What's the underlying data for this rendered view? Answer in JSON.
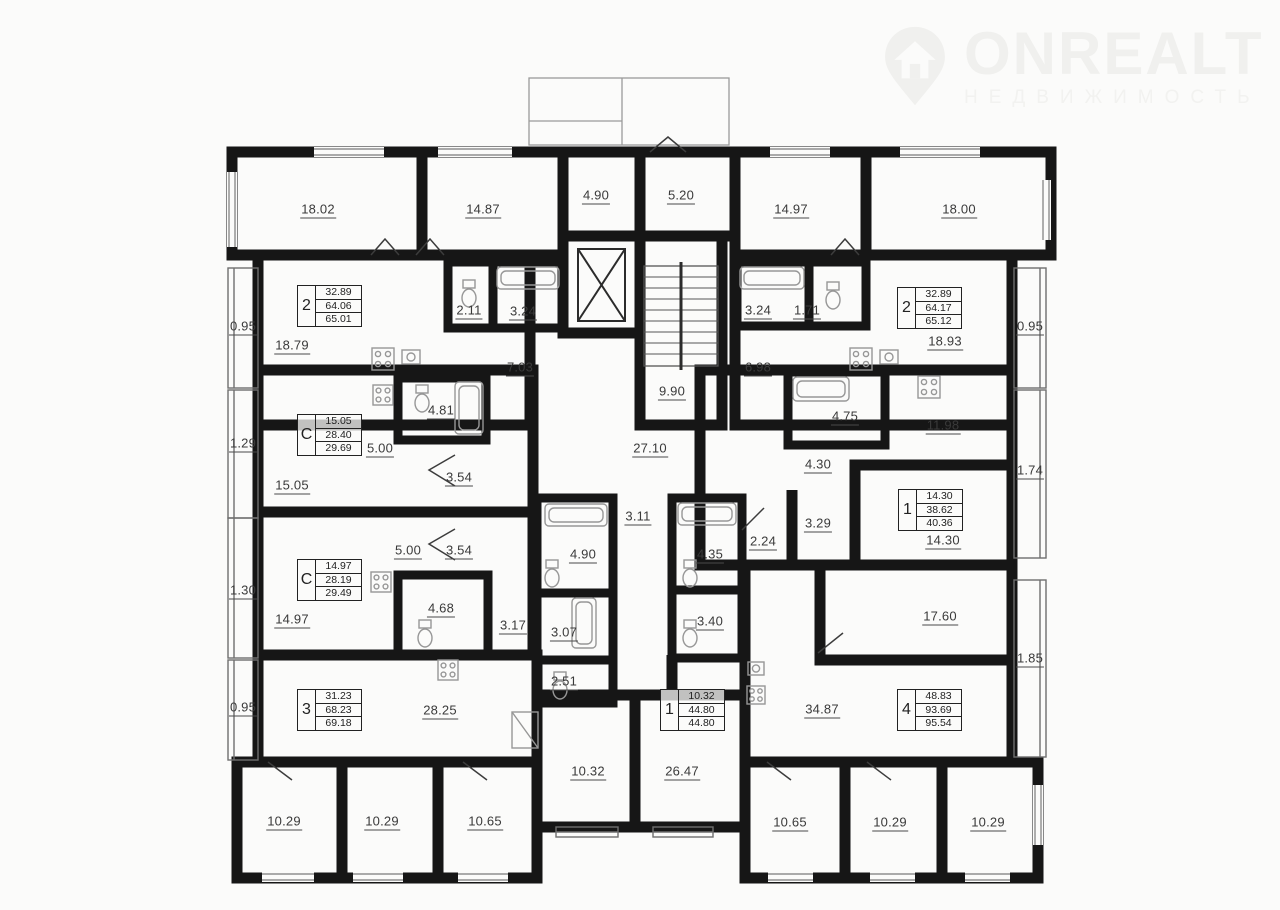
{
  "watermark": {
    "brand": "ONREALT",
    "tagline": "НЕДВИЖИМОСТЬ"
  },
  "colors": {
    "background": "#fbfbfa",
    "wall": "#161616",
    "label": "#3a3a3a",
    "watermark": "#f0f0ee"
  },
  "floorplan": {
    "room_labels": [
      {
        "value": "18.02",
        "x": 318,
        "y": 210
      },
      {
        "value": "14.87",
        "x": 483,
        "y": 210
      },
      {
        "value": "4.90",
        "x": 596,
        "y": 196
      },
      {
        "value": "5.20",
        "x": 681,
        "y": 196
      },
      {
        "value": "14.97",
        "x": 791,
        "y": 210
      },
      {
        "value": "18.00",
        "x": 959,
        "y": 210
      },
      {
        "value": "0.95",
        "x": 243,
        "y": 327
      },
      {
        "value": "1.29",
        "x": 243,
        "y": 444
      },
      {
        "value": "1.30",
        "x": 243,
        "y": 591
      },
      {
        "value": "0.95",
        "x": 243,
        "y": 708
      },
      {
        "value": "0.95",
        "x": 1030,
        "y": 327
      },
      {
        "value": "1.74",
        "x": 1030,
        "y": 471
      },
      {
        "value": "1.85",
        "x": 1030,
        "y": 659
      },
      {
        "value": "18.79",
        "x": 292,
        "y": 346
      },
      {
        "value": "2.11",
        "x": 469,
        "y": 311
      },
      {
        "value": "3.24",
        "x": 523,
        "y": 312
      },
      {
        "value": "7.03",
        "x": 520,
        "y": 368
      },
      {
        "value": "9.90",
        "x": 672,
        "y": 392
      },
      {
        "value": "3.24",
        "x": 758,
        "y": 311
      },
      {
        "value": "1.71",
        "x": 807,
        "y": 311
      },
      {
        "value": "6.98",
        "x": 758,
        "y": 368
      },
      {
        "value": "18.93",
        "x": 945,
        "y": 342
      },
      {
        "value": "4.81",
        "x": 441,
        "y": 411
      },
      {
        "value": "5.00",
        "x": 380,
        "y": 449
      },
      {
        "value": "3.54",
        "x": 459,
        "y": 478
      },
      {
        "value": "15.05",
        "x": 292,
        "y": 486
      },
      {
        "value": "27.10",
        "x": 650,
        "y": 449
      },
      {
        "value": "4.75",
        "x": 845,
        "y": 417
      },
      {
        "value": "11.98",
        "x": 943,
        "y": 426
      },
      {
        "value": "4.30",
        "x": 818,
        "y": 465
      },
      {
        "value": "3.29",
        "x": 818,
        "y": 524
      },
      {
        "value": "14.30",
        "x": 943,
        "y": 541
      },
      {
        "value": "5.00",
        "x": 408,
        "y": 551
      },
      {
        "value": "3.54",
        "x": 459,
        "y": 551
      },
      {
        "value": "4.68",
        "x": 441,
        "y": 609
      },
      {
        "value": "14.97",
        "x": 292,
        "y": 620
      },
      {
        "value": "3.11",
        "x": 638,
        "y": 517
      },
      {
        "value": "4.90",
        "x": 583,
        "y": 555
      },
      {
        "value": "4.35",
        "x": 710,
        "y": 555
      },
      {
        "value": "2.24",
        "x": 763,
        "y": 542
      },
      {
        "value": "3.17",
        "x": 513,
        "y": 626
      },
      {
        "value": "3.07",
        "x": 564,
        "y": 633
      },
      {
        "value": "3.40",
        "x": 710,
        "y": 622
      },
      {
        "value": "2.51",
        "x": 564,
        "y": 682
      },
      {
        "value": "17.60",
        "x": 940,
        "y": 617
      },
      {
        "value": "34.87",
        "x": 822,
        "y": 710
      },
      {
        "value": "28.25",
        "x": 440,
        "y": 711
      },
      {
        "value": "10.29",
        "x": 284,
        "y": 822
      },
      {
        "value": "10.29",
        "x": 382,
        "y": 822
      },
      {
        "value": "10.65",
        "x": 485,
        "y": 822
      },
      {
        "value": "10.32",
        "x": 588,
        "y": 772
      },
      {
        "value": "26.47",
        "x": 682,
        "y": 772
      },
      {
        "value": "10.65",
        "x": 790,
        "y": 823
      },
      {
        "value": "10.29",
        "x": 890,
        "y": 823
      },
      {
        "value": "10.29",
        "x": 988,
        "y": 823
      }
    ],
    "apartment_cards": [
      {
        "type": "2",
        "values": [
          "32.89",
          "64.06",
          "65.01"
        ],
        "x": 297,
        "y": 285
      },
      {
        "type": "2",
        "values": [
          "32.89",
          "64.17",
          "65.12"
        ],
        "x": 897,
        "y": 287
      },
      {
        "type": "С",
        "values": [
          "15.05",
          "28.40",
          "29.69"
        ],
        "x": 297,
        "y": 414
      },
      {
        "type": "С",
        "values": [
          "14.97",
          "28.19",
          "29.49"
        ],
        "x": 297,
        "y": 559
      },
      {
        "type": "1",
        "values": [
          "14.30",
          "38.62",
          "40.36"
        ],
        "x": 898,
        "y": 489
      },
      {
        "type": "3",
        "values": [
          "31.23",
          "68.23",
          "69.18"
        ],
        "x": 297,
        "y": 689
      },
      {
        "type": "1",
        "values": [
          "10.32",
          "44.80",
          "44.80"
        ],
        "x": 660,
        "y": 689
      },
      {
        "type": "4",
        "values": [
          "48.83",
          "93.69",
          "95.54"
        ],
        "x": 897,
        "y": 689
      }
    ]
  }
}
